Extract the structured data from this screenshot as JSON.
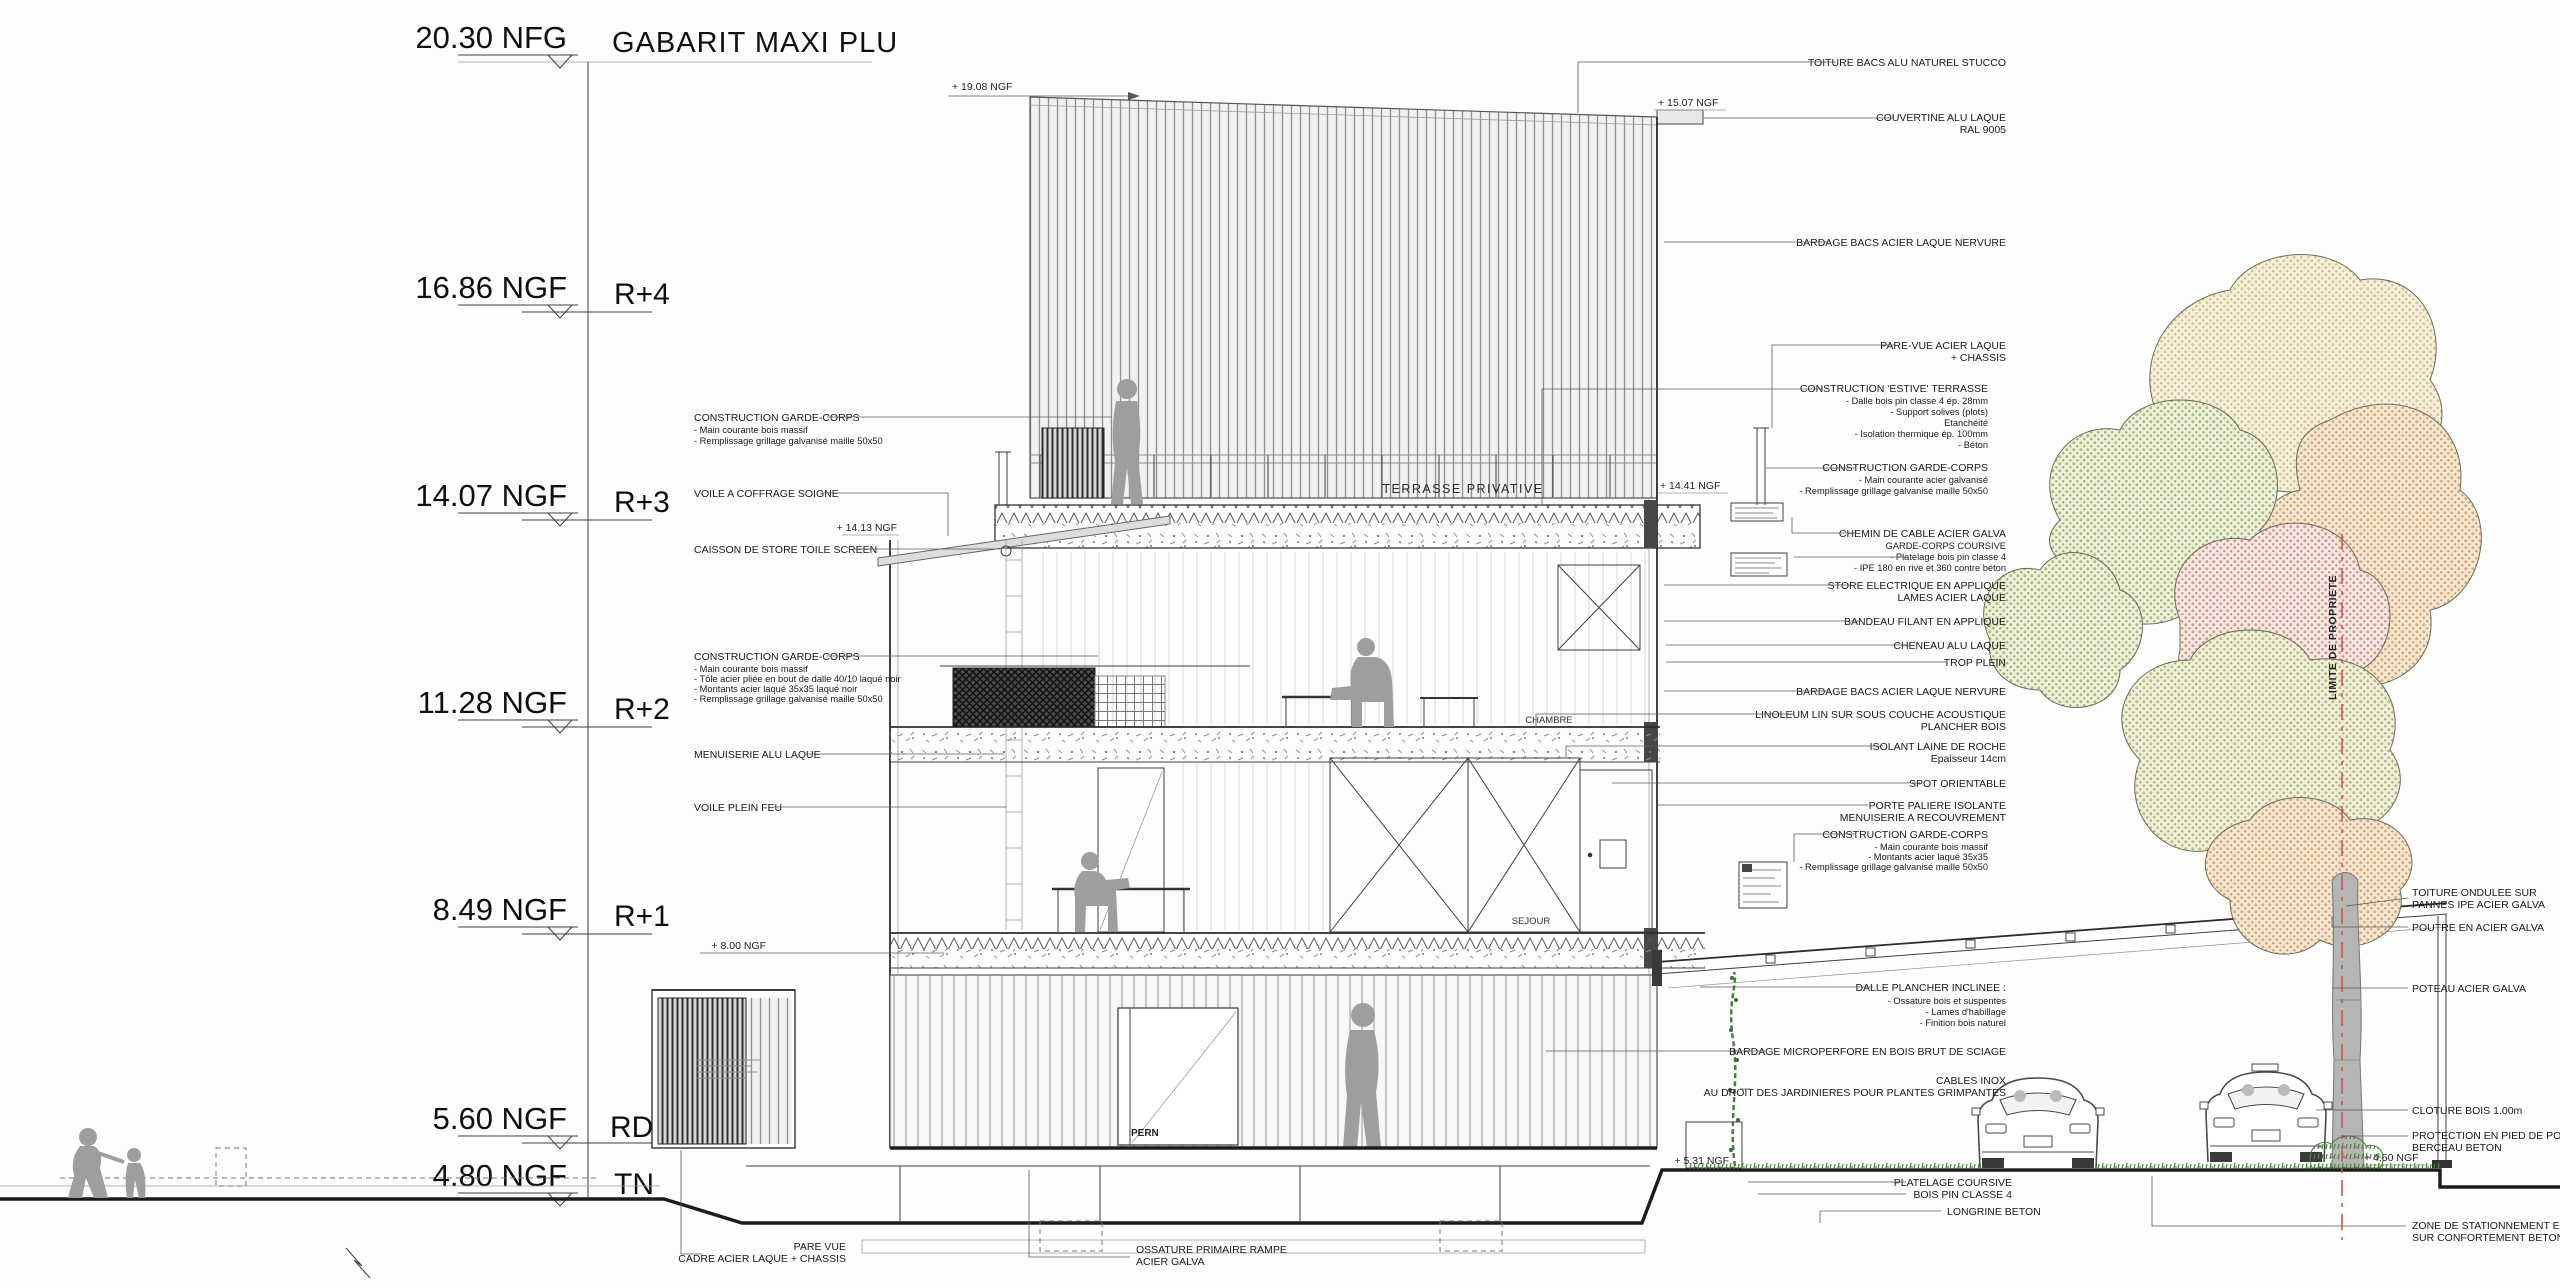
{
  "title_note": "GABARIT MAXI PLU",
  "levels": [
    {
      "elev": "20.30 NFG",
      "label": "GABARIT MAXI PLU"
    },
    {
      "elev": "16.86 NGF",
      "label": "R+4"
    },
    {
      "elev": "14.07 NGF",
      "label": "R+3"
    },
    {
      "elev": "11.28 NGF",
      "label": "R+2"
    },
    {
      "elev": "8.49 NGF",
      "label": "R+1"
    },
    {
      "elev": "5.60 NGF",
      "label": "RDC"
    },
    {
      "elev": "4.80 NGF",
      "label": "TN"
    }
  ],
  "spots": {
    "s1908": "+ 19.08 NGF",
    "s1507": "+ 15.07 NGF",
    "s1441": "+ 14.41 NGF",
    "s1413": "+ 14.13 NGF",
    "s800": "+ 8.00 NGF",
    "s531": "+ 5.31 NGF",
    "s450": "+ 4.50 NGF"
  },
  "rooms": {
    "terrace": "TERRASSE PRIVATIVE",
    "bedroom": "CHAMBRE",
    "living": "SEJOUR",
    "door_tag": "PERN"
  },
  "property_line": "LIMITE DE PROPRIETE",
  "left_notes": {
    "gc_top": {
      "t": "CONSTRUCTION GARDE-CORPS",
      "l1": "- Main courante bois massif",
      "l2": "- Remplissage grillage galvanisé maille 50x50"
    },
    "voile": "VOILE A COFFRAGE SOIGNE",
    "caisson": "CAISSON DE STORE TOILE SCREEN",
    "gc_mid": {
      "t": "CONSTRUCTION GARDE-CORPS",
      "l1": "- Main courante bois massif",
      "l2": "- Tôle acier pliée en bout de dalle 40/10 laqué noir",
      "l3": "- Montants acier laqué 35x35 laqué noir",
      "l4": "- Remplissage grillage galvanisé maille 50x50"
    },
    "menuiserie": "MENUISERIE ALU LAQUE",
    "voile2": "VOILE PLEIN FEU"
  },
  "right_notes": {
    "toiture": "TOITURE BACS ALU NATUREL STUCCO",
    "couvertine1": "COUVERTINE ALU LAQUE",
    "couvertine2": "RAL 9005",
    "bardage_top": "BARDAGE BACS ACIER LAQUE NERVURE",
    "parevue1": "PARE-VUE ACIER LAQUE",
    "parevue2": "+ CHASSIS",
    "estive_t": "CONSTRUCTION 'ESTIVE' TERRASSE",
    "estive1": "- Dalle bois pin classe 4 ép. 28mm",
    "estive2": "- Support solives (plots)",
    "estive3": "Etanchéité",
    "estive4": "- Isolation thermique ép. 100mm",
    "estive5": "- Béton",
    "gc2_t": "CONSTRUCTION GARDE-CORPS",
    "gc2_1": "- Main courante acier galvanisé",
    "gc2_2": "- Remplissage grillage galvanisé maille 50x50",
    "chemin": "CHEMIN DE CABLE ACIER GALVA",
    "coursive_t": "GARDE-CORPS COURSIVE",
    "coursive1": "- Platelage bois pin classe 4",
    "coursive2": "- IPE 180 en rive et 360 contre béton",
    "store1": "STORE ELECTRIQUE EN APPLIQUE",
    "store2": "LAMES ACIER LAQUE",
    "bandeau": "BANDEAU FILANT EN APPLIQUE",
    "cheneau": "CHENEAU ALU LAQUE",
    "trop": "TROP PLEIN",
    "bardage2": "BARDAGE BACS ACIER LAQUE NERVURE",
    "lino1": "LINOLEUM LIN SUR SOUS COUCHE ACOUSTIQUE",
    "lino2": "PLANCHER BOIS",
    "isolant1": "ISOLANT LAINE DE ROCHE",
    "isolant2": "Epaisseur 14cm",
    "spot": "SPOT ORIENTABLE",
    "porte1": "PORTE PALIERE ISOLANTE",
    "porte2": "MENUISERIE A RECOUVREMENT",
    "gc3_t": "CONSTRUCTION GARDE-CORPS",
    "gc3_1": "- Main courante bois massif",
    "gc3_2": "- Montants acier laqué 35x35",
    "gc3_3": "- Remplissage grillage galvanisé maille 50x50",
    "dalle_t": "DALLE PLANCHER INCLINEE :",
    "dalle1": "- Ossature bois et suspentes",
    "dalle2": "- Lames d'habillage",
    "dalle3": "- Finition bois naturel",
    "microperf": "BARDAGE MICROPERFORE EN BOIS BRUT DE SCIAGE",
    "cables1": "CABLES INOX",
    "cables2": "AU DROIT DES JARDINIERES POUR PLANTES GRIMPANTES"
  },
  "farright_notes": {
    "ondulee1": "TOITURE ONDULEE SUR",
    "ondulee2": "PANNES IPE ACIER GALVA",
    "poutre": "POUTRE EN ACIER GALVA",
    "poteau": "POTEAU ACIER GALVA",
    "cloture": "CLOTURE BOIS 1.00m",
    "protection1": "PROTECTION EN PIED DE POTEAU",
    "protection2": "BERCEAU BETON",
    "zone1": "ZONE DE STATIONNEMENT ENROBE",
    "zone2": "SUR CONFORTEMENT BETON ARME"
  },
  "bottom_notes": {
    "parevue1": "PARE VUE",
    "parevue2": "CADRE ACIER LAQUE + CHASSIS",
    "ossature1": "OSSATURE PRIMAIRE RAMPE",
    "ossature2": "ACIER GALVA",
    "platelage1": "PLATELAGE COURSIVE",
    "platelage2": "BOIS PIN CLASSE 4",
    "longrine": "LONGRINE BETON"
  },
  "colors": {
    "line": "#3f3f3f",
    "annotation": "#1a1a1a",
    "property_red": "#cf5650",
    "grass_green": "#4e7d46",
    "tree_olive": "#bcbd85",
    "tree_peach": "#ddab77",
    "tree_pink": "#d49a8e",
    "tree_green": "#a9bd7f",
    "tree_cream": "#d8c79a",
    "silhouette_grey": "#9e9e9e"
  }
}
